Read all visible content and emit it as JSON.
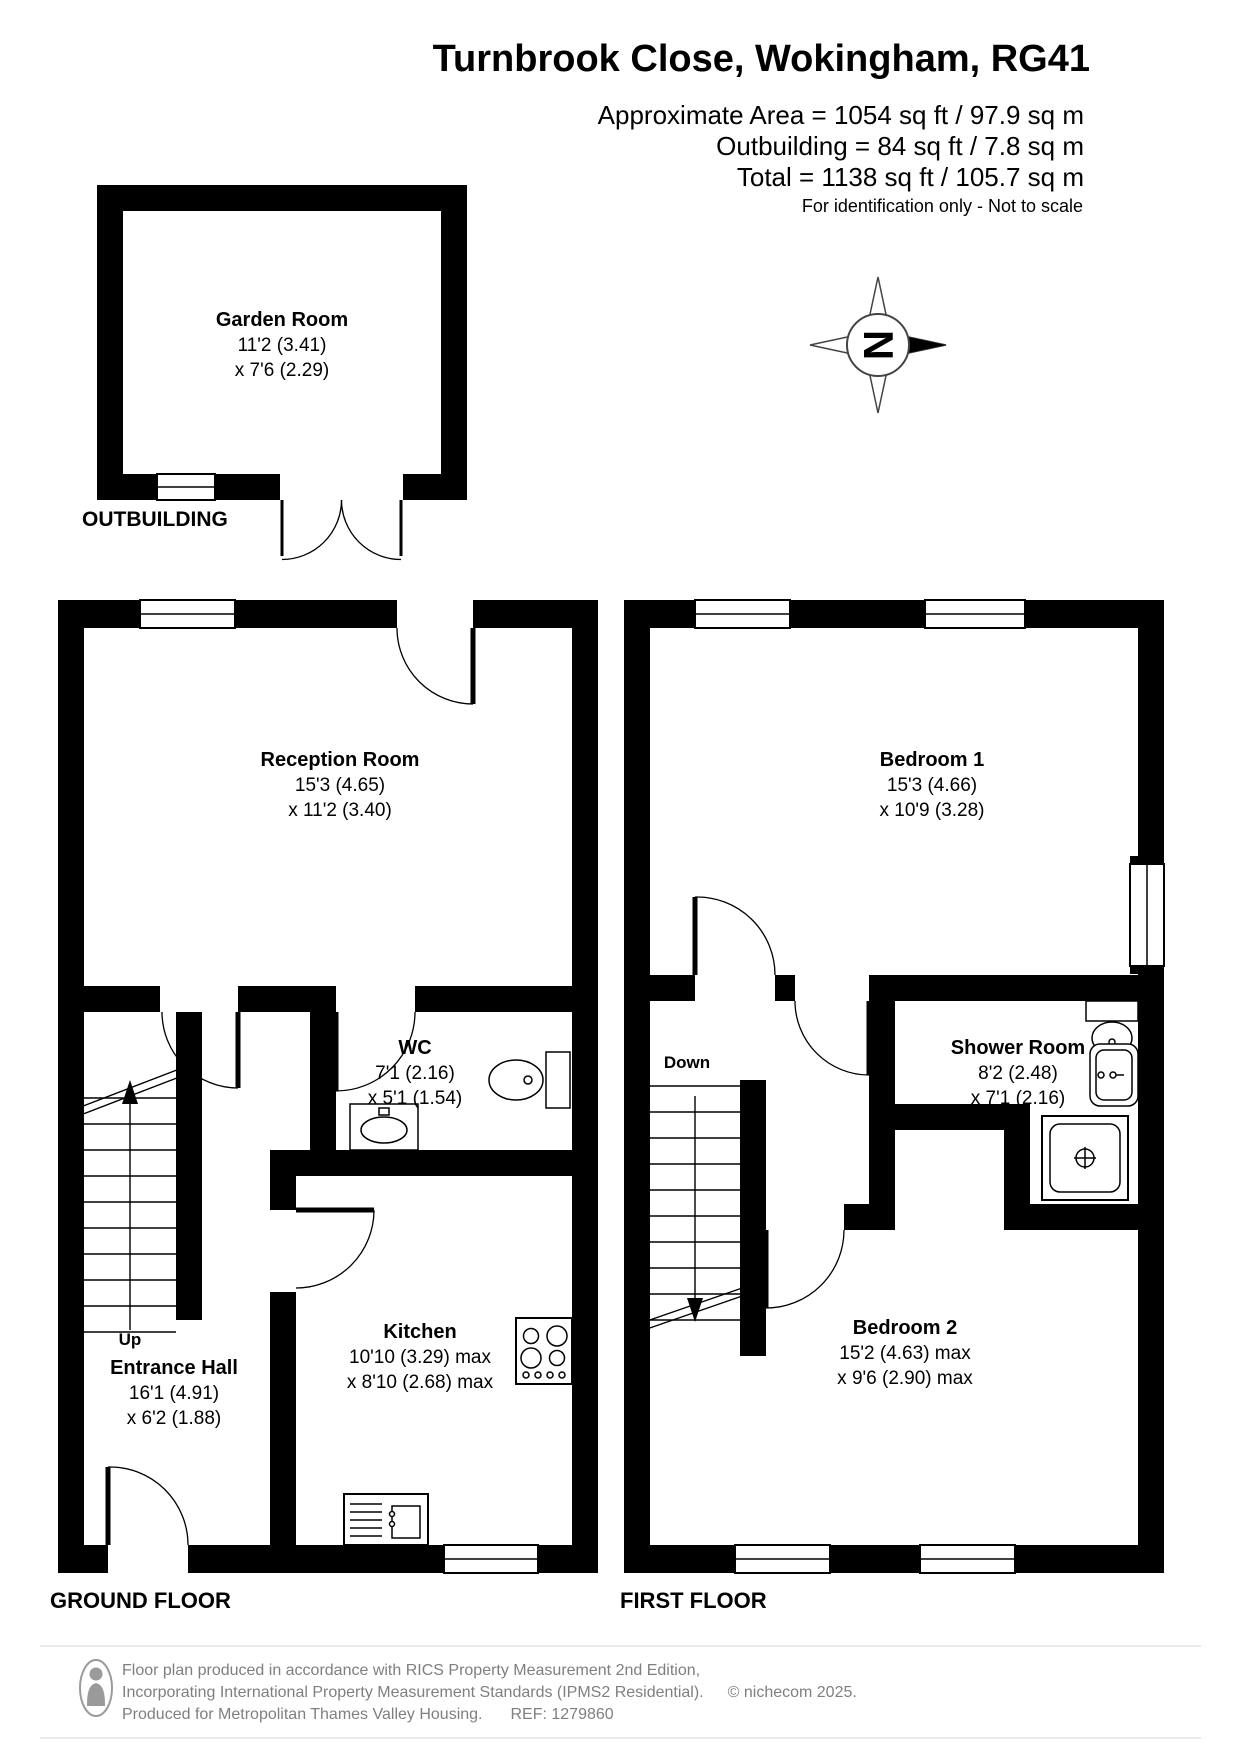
{
  "header": {
    "title": "Turnbrook Close, Wokingham, RG41",
    "area_line1": "Approximate Area = 1054 sq ft / 97.9 sq m",
    "area_line2": "Outbuilding = 84 sq ft / 7.8 sq m",
    "area_line3": "Total = 1138 sq ft / 105.7 sq m",
    "disclaimer": "For identification only - Not to scale"
  },
  "compass": {
    "north_letter": "N"
  },
  "floors": {
    "outbuilding": {
      "label": "OUTBUILDING",
      "garden_room": {
        "name": "Garden Room",
        "dim1": "11'2 (3.41)",
        "dim2": "x 7'6 (2.29)"
      }
    },
    "ground": {
      "label": "GROUND FLOOR",
      "stairs_label": "Up",
      "reception": {
        "name": "Reception Room",
        "dim1": "15'3 (4.65)",
        "dim2": "x 11'2 (3.40)"
      },
      "wc": {
        "name": "WC",
        "dim1": "7'1 (2.16)",
        "dim2": "x 5'1 (1.54)"
      },
      "kitchen": {
        "name": "Kitchen",
        "dim1": "10'10 (3.29) max",
        "dim2": "x 8'10 (2.68) max"
      },
      "entrance_hall": {
        "name": "Entrance Hall",
        "dim1": "16'1 (4.91)",
        "dim2": "x 6'2 (1.88)"
      }
    },
    "first": {
      "label": "FIRST FLOOR",
      "stairs_label": "Down",
      "bedroom1": {
        "name": "Bedroom 1",
        "dim1": "15'3 (4.66)",
        "dim2": "x 10'9 (3.28)"
      },
      "shower_room": {
        "name": "Shower Room",
        "dim1": "8'2 (2.48)",
        "dim2": "x 7'1 (2.16)"
      },
      "bedroom2": {
        "name": "Bedroom 2",
        "dim1": "15'2 (4.63) max",
        "dim2": "x 9'6 (2.90) max"
      }
    }
  },
  "footer": {
    "line1": "Floor plan produced in accordance with RICS Property Measurement 2nd Edition,",
    "line2": "Incorporating International Property Measurement Standards (IPMS2 Residential).",
    "copyright": "© nichecom 2025.",
    "line3": "Produced for Metropolitan Thames Valley Housing.",
    "ref": "REF:  1279860"
  }
}
